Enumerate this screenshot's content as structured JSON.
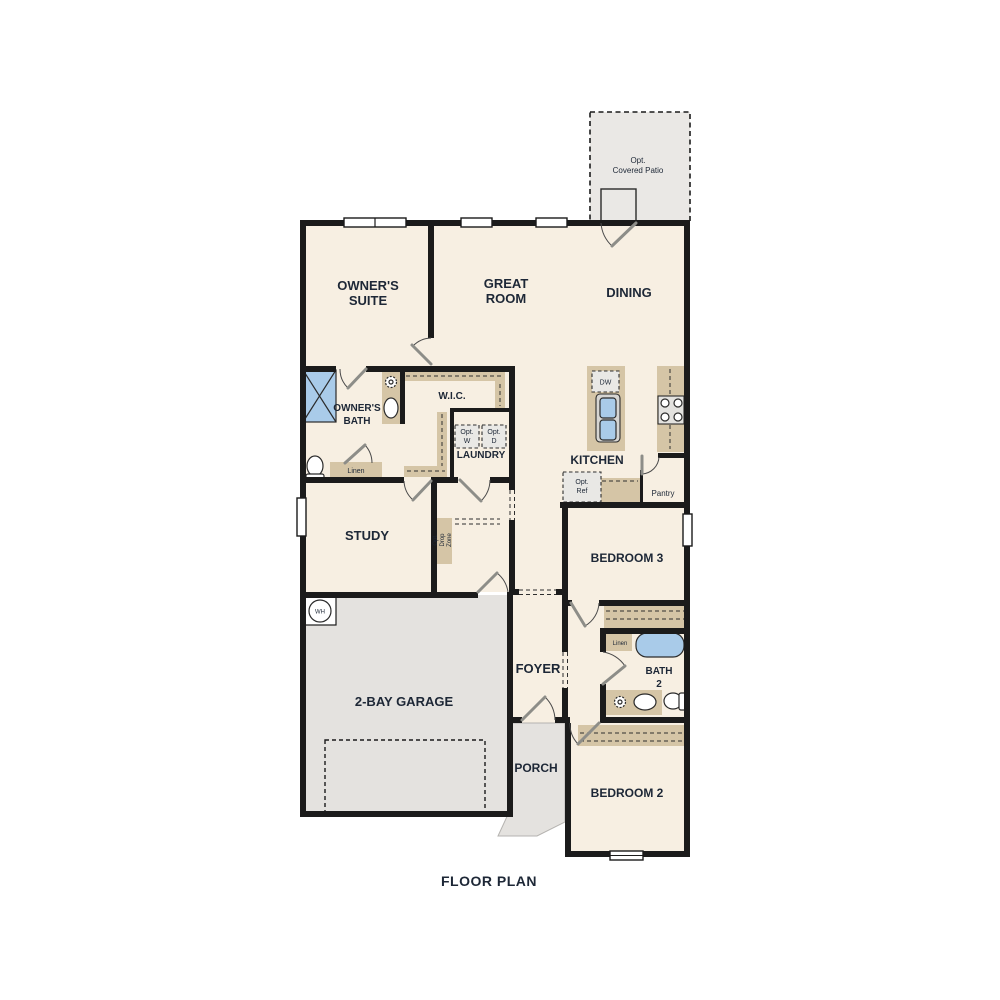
{
  "title": "FLOOR PLAN",
  "palette": {
    "room_fill": "#f7efe2",
    "garage_fill": "#e4e2df",
    "patio_fill": "#eae8e5",
    "counter_tan": "#d5c5a6",
    "fixture_blue": "#a9cbe9",
    "wall": "#1b1b1b",
    "text": "#1d2736",
    "door_leaf": "#8d8d88"
  },
  "rooms": {
    "patio": {
      "line1": "Opt.",
      "line2": "Covered Patio"
    },
    "owners_suite": {
      "line1": "OWNER'S",
      "line2": "SUITE"
    },
    "great_room": {
      "line1": "GREAT",
      "line2": "ROOM"
    },
    "dining": {
      "label": "DINING"
    },
    "owners_bath": {
      "line1": "OWNER'S",
      "line2": "BATH"
    },
    "wic": {
      "label": "W.I.C."
    },
    "laundry": {
      "label": "LAUNDRY"
    },
    "kitchen": {
      "label": "KITCHEN"
    },
    "pantry": {
      "label": "Pantry"
    },
    "study": {
      "label": "STUDY"
    },
    "bedroom3": {
      "label": "BEDROOM 3"
    },
    "foyer": {
      "label": "FOYER"
    },
    "bath2": {
      "line1": "BATH",
      "line2": "2"
    },
    "garage": {
      "label": "2-BAY GARAGE"
    },
    "porch": {
      "label": "PORCH"
    },
    "bedroom2": {
      "label": "BEDROOM 2"
    }
  },
  "features": {
    "linen_owners": "Linen",
    "linen_bath2": "Linen",
    "opt_washer": {
      "line1": "Opt.",
      "line2": "W"
    },
    "opt_dryer": {
      "line1": "Opt.",
      "line2": "D"
    },
    "dishwasher": "DW",
    "opt_fridge": {
      "line1": "Opt.",
      "line2": "Ref"
    },
    "water_heater": "WH",
    "drop_zone": {
      "line1": "Opt.",
      "line2": "Drop",
      "line3": "Zone"
    }
  }
}
